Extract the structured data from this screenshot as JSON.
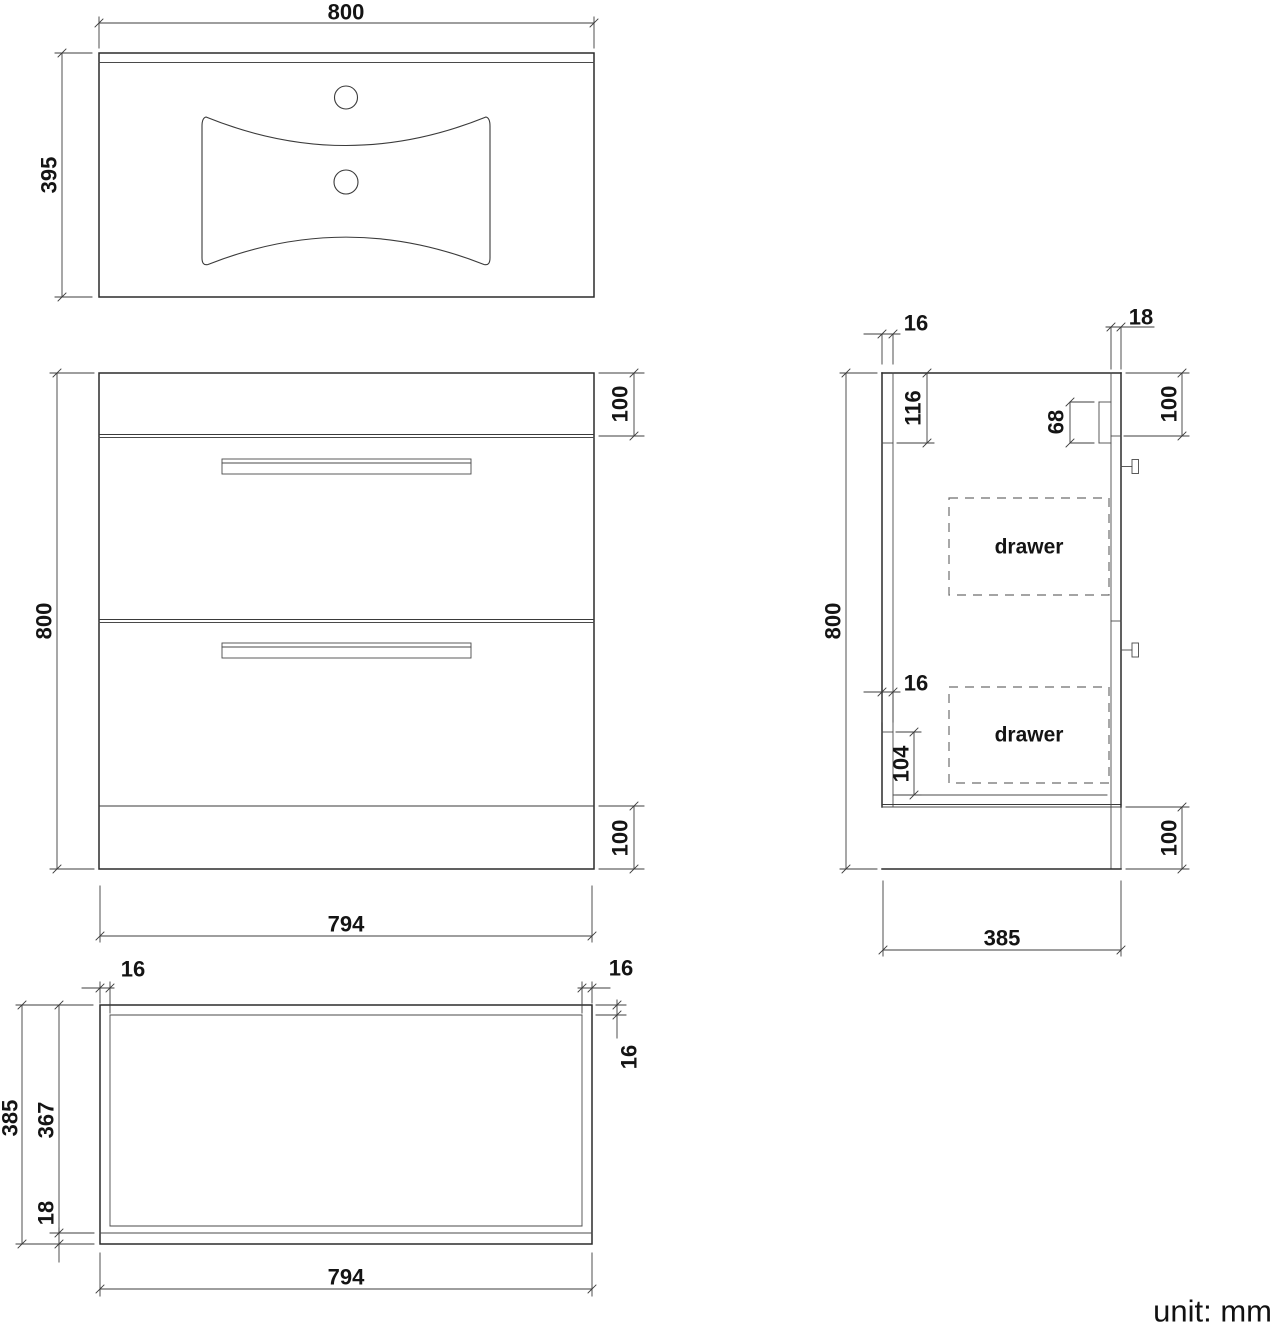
{
  "caption": {
    "units": "unit: mm"
  },
  "top_view": {
    "name": "basin top view",
    "width": "800",
    "depth": "395"
  },
  "front_view": {
    "name": "cabinet front view",
    "height": "800",
    "top_band": "100",
    "bottom_band": "100",
    "width": "794"
  },
  "side_view": {
    "name": "cabinet side section view",
    "back_thickness": "16",
    "front_thickness": "18",
    "back_top_rail": "116",
    "drawer_rail": "68",
    "top_band": "100",
    "height": "800",
    "mid_thickness": "16",
    "bottom_rail": "104",
    "drawer_label": "drawer",
    "bottom_band": "100",
    "depth": "385"
  },
  "bottom_view": {
    "name": "cabinet bottom plan view",
    "left_thickness": "16",
    "right_thickness": "16",
    "back_thickness": "16",
    "outer_depth": "385",
    "inner_depth": "367",
    "front_thickness": "18",
    "width": "794"
  }
}
